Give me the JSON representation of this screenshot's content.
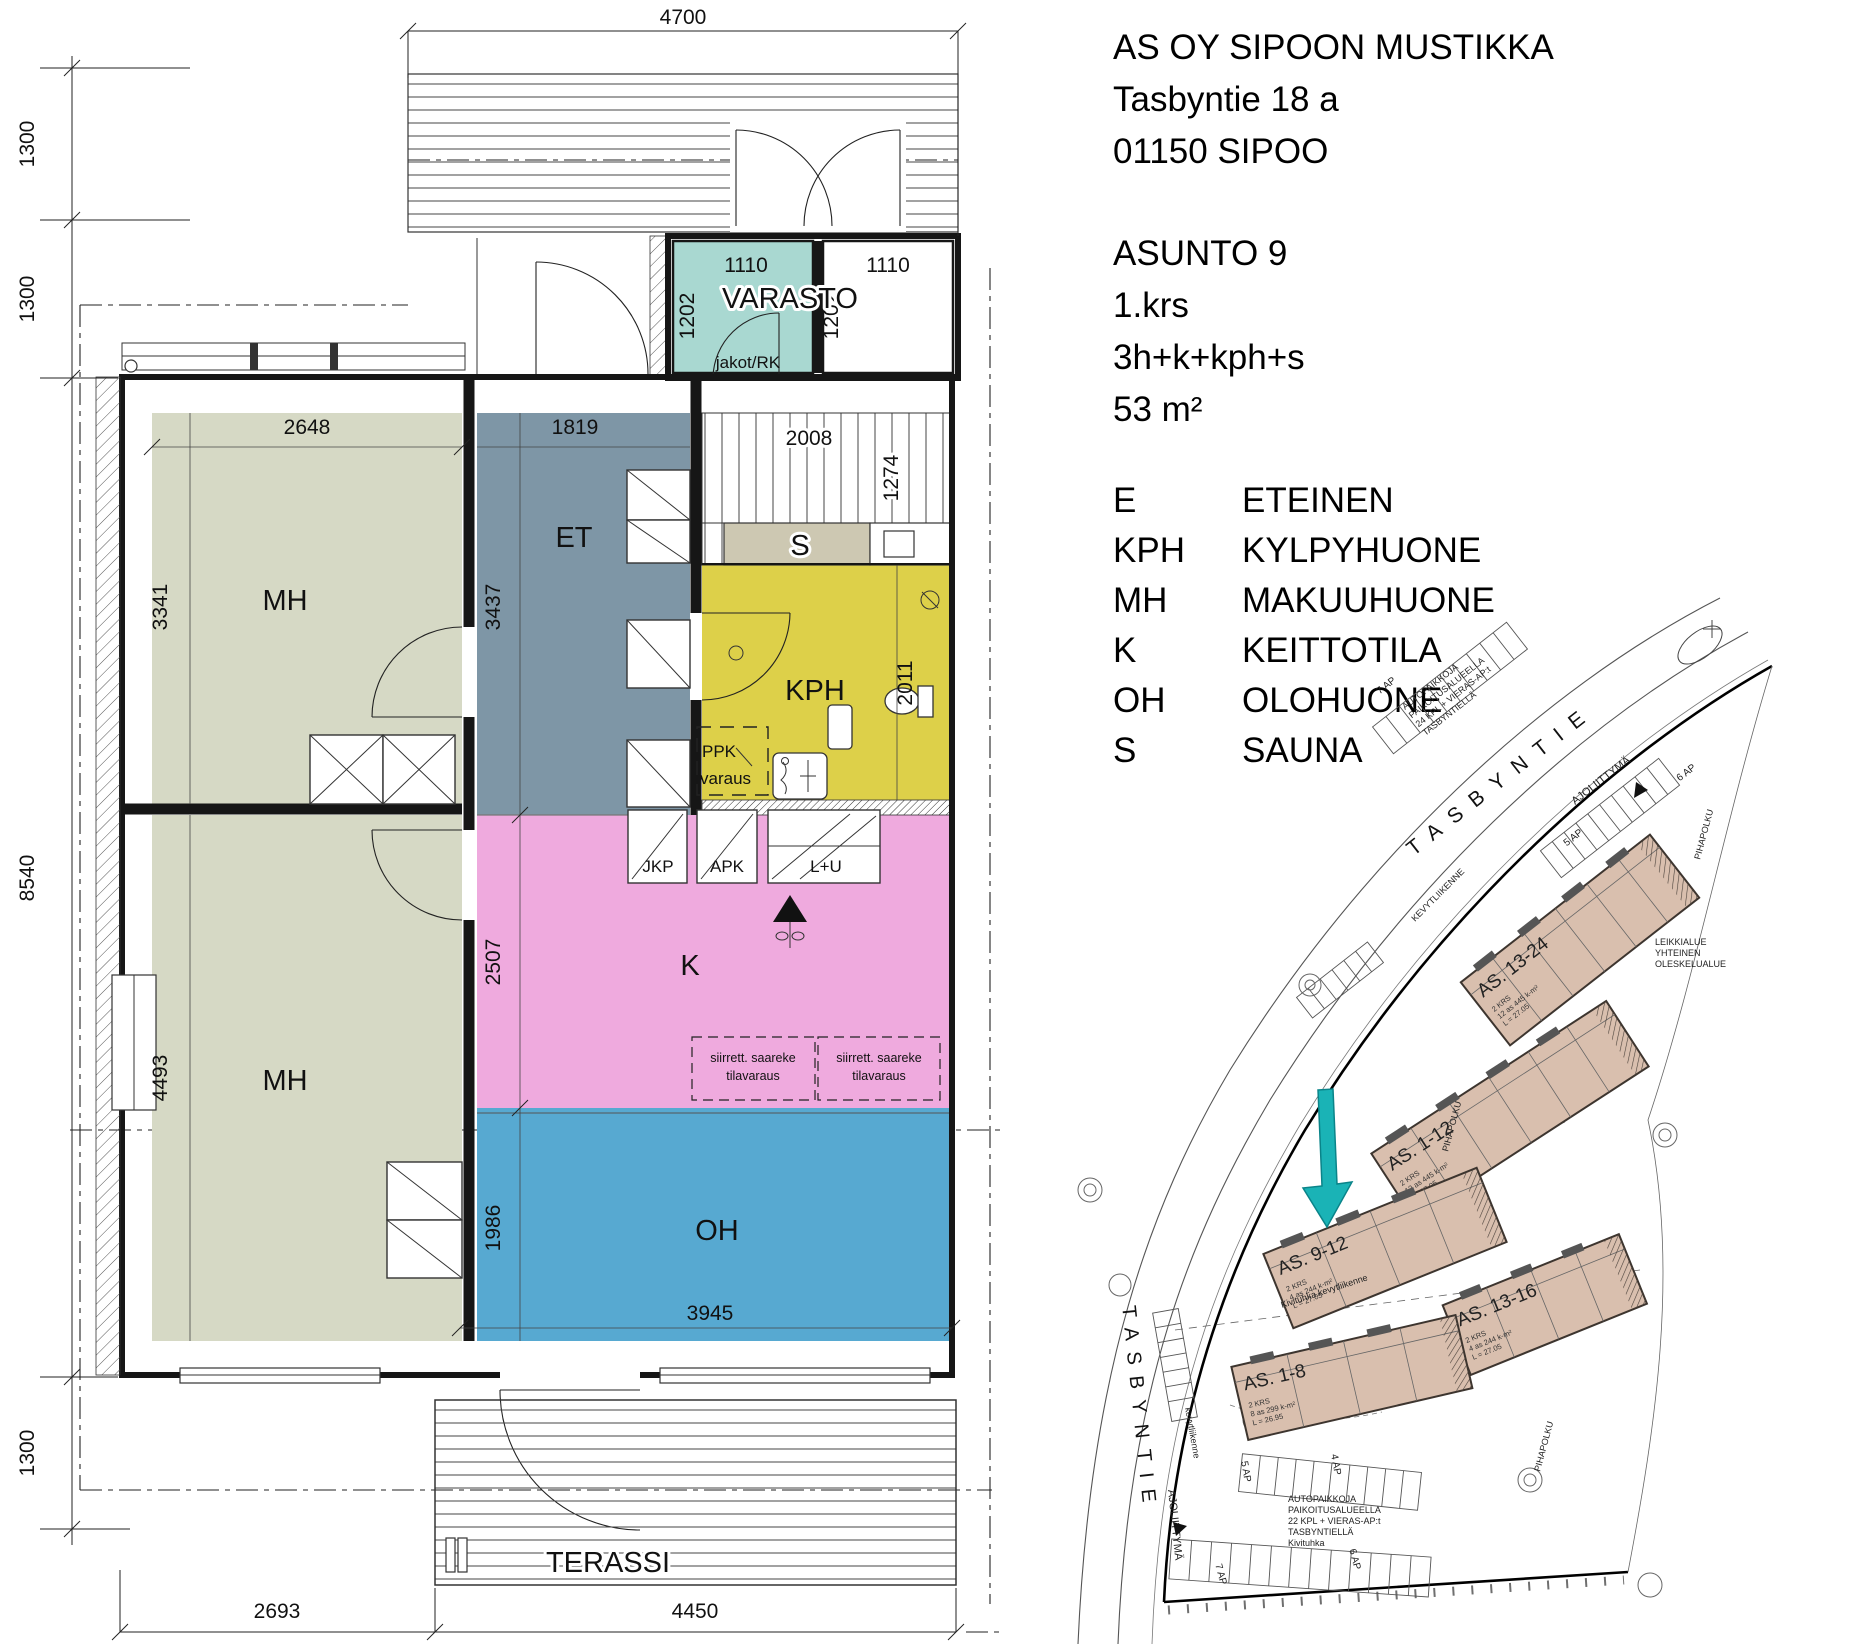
{
  "info": {
    "company": "AS OY SIPOON MUSTIKKA",
    "address": "Tasbyntie 18 a",
    "city": "01150 SIPOO",
    "apartment": "ASUNTO 9",
    "floor": "1.krs",
    "layout": "3h+k+kph+s",
    "area": "53 m²"
  },
  "legend": [
    {
      "abbr": "E",
      "name": "ETEINEN"
    },
    {
      "abbr": "KPH",
      "name": "KYLPYHUONE"
    },
    {
      "abbr": "MH",
      "name": "MAKUUHUONE"
    },
    {
      "abbr": "K",
      "name": "KEITTOTILA"
    },
    {
      "abbr": "OH",
      "name": "OLOHUONE"
    },
    {
      "abbr": "S",
      "name": "SAUNA"
    }
  ],
  "floorplan": {
    "rooms": {
      "varasto": "VARASTO",
      "et": "ET",
      "mh_top": "MH",
      "mh_bottom": "MH",
      "kph": "KPH",
      "sauna": "S",
      "kitchen": "K",
      "living": "OH",
      "terrace": "TERASSI"
    },
    "labels": {
      "jakot": "jakot/RK",
      "ppk1": "PPK",
      "ppk2": "varaus",
      "jkp": "JKP",
      "apk": "APK",
      "lu": "L+U",
      "island1": "siirrett. saareke",
      "island2": "tilavaraus"
    },
    "dims": {
      "top": "4700",
      "left": [
        "1300",
        "1300",
        "8540",
        "1300"
      ],
      "bottom": [
        "2693",
        "4450"
      ],
      "varasto": [
        "1110",
        "1202",
        "1110",
        "1202"
      ],
      "mh_top": [
        "2648",
        "3341"
      ],
      "et": [
        "1819",
        "3437"
      ],
      "sauna": [
        "2008",
        "1274"
      ],
      "kph": "2011",
      "mh_bottom": "4493",
      "kitchen": "2507",
      "living": [
        "1986",
        "3945"
      ]
    }
  },
  "siteplan": {
    "street": "TASBYNTIE",
    "ajoliittyma": "AJOLIITTYMÄ",
    "kevytliikenne": "KEVYTLIIKENNE",
    "kevytliikenne2": "kevytliikenne",
    "kivituhka": "Kivituhka kevytliikenne",
    "pihapolku": "PIHAPOLKU",
    "buildings": [
      {
        "label": "AS. 13-24",
        "info": [
          "2 KRS",
          "12 as 445 k-m²",
          "L = 27.05"
        ]
      },
      {
        "label": "AS. 1-12",
        "info": [
          "2 KRS",
          "12 as 445 k-m²",
          "L = 27.05"
        ]
      },
      {
        "label": "AS. 9-12",
        "info": [
          "2 KRS",
          "4 as 244 k-m²",
          "L = 27.05"
        ]
      },
      {
        "label": "AS. 13-16",
        "info": [
          "2 KRS",
          "4 as 244 k-m²",
          "L = 27.05"
        ]
      },
      {
        "label": "AS. 1-8",
        "info": [
          "2 KRS",
          "8 as 299 k-m²",
          "L = 26.95"
        ]
      }
    ],
    "parking": [
      "7 AP",
      "5 AP",
      "6 AP",
      "5 AP",
      "4 AP",
      "7 AP",
      "6 AP"
    ],
    "notes_top": [
      "AUTOPAIKKOJA",
      "PAIKOITUSALUEELLA",
      "24 KPL + VIERAS-AP:t",
      "TASBYNTIELLÄ"
    ],
    "notes_bottom": [
      "AUTOPAIKKOJA",
      "PAIKOITUSALUEELLA",
      "22 KPL + VIERAS-AP:t",
      "TASBYNTIELLÄ",
      "Kivituhka"
    ],
    "leikkialue": [
      "LEIKKIALUE",
      "YHTEINEN",
      "OLESKELUALUE"
    ]
  },
  "colors": {
    "varasto": "#a9d8d1",
    "bedroom": "#d6d9c5",
    "hallway": "#7e96a6",
    "bathroom": "#ddd049",
    "sauna_bench": "#cdc8b2",
    "kitchen": "#efaade",
    "living": "#57a9d1",
    "building": "#d9bfae",
    "arrow": "#1ab3b6"
  }
}
